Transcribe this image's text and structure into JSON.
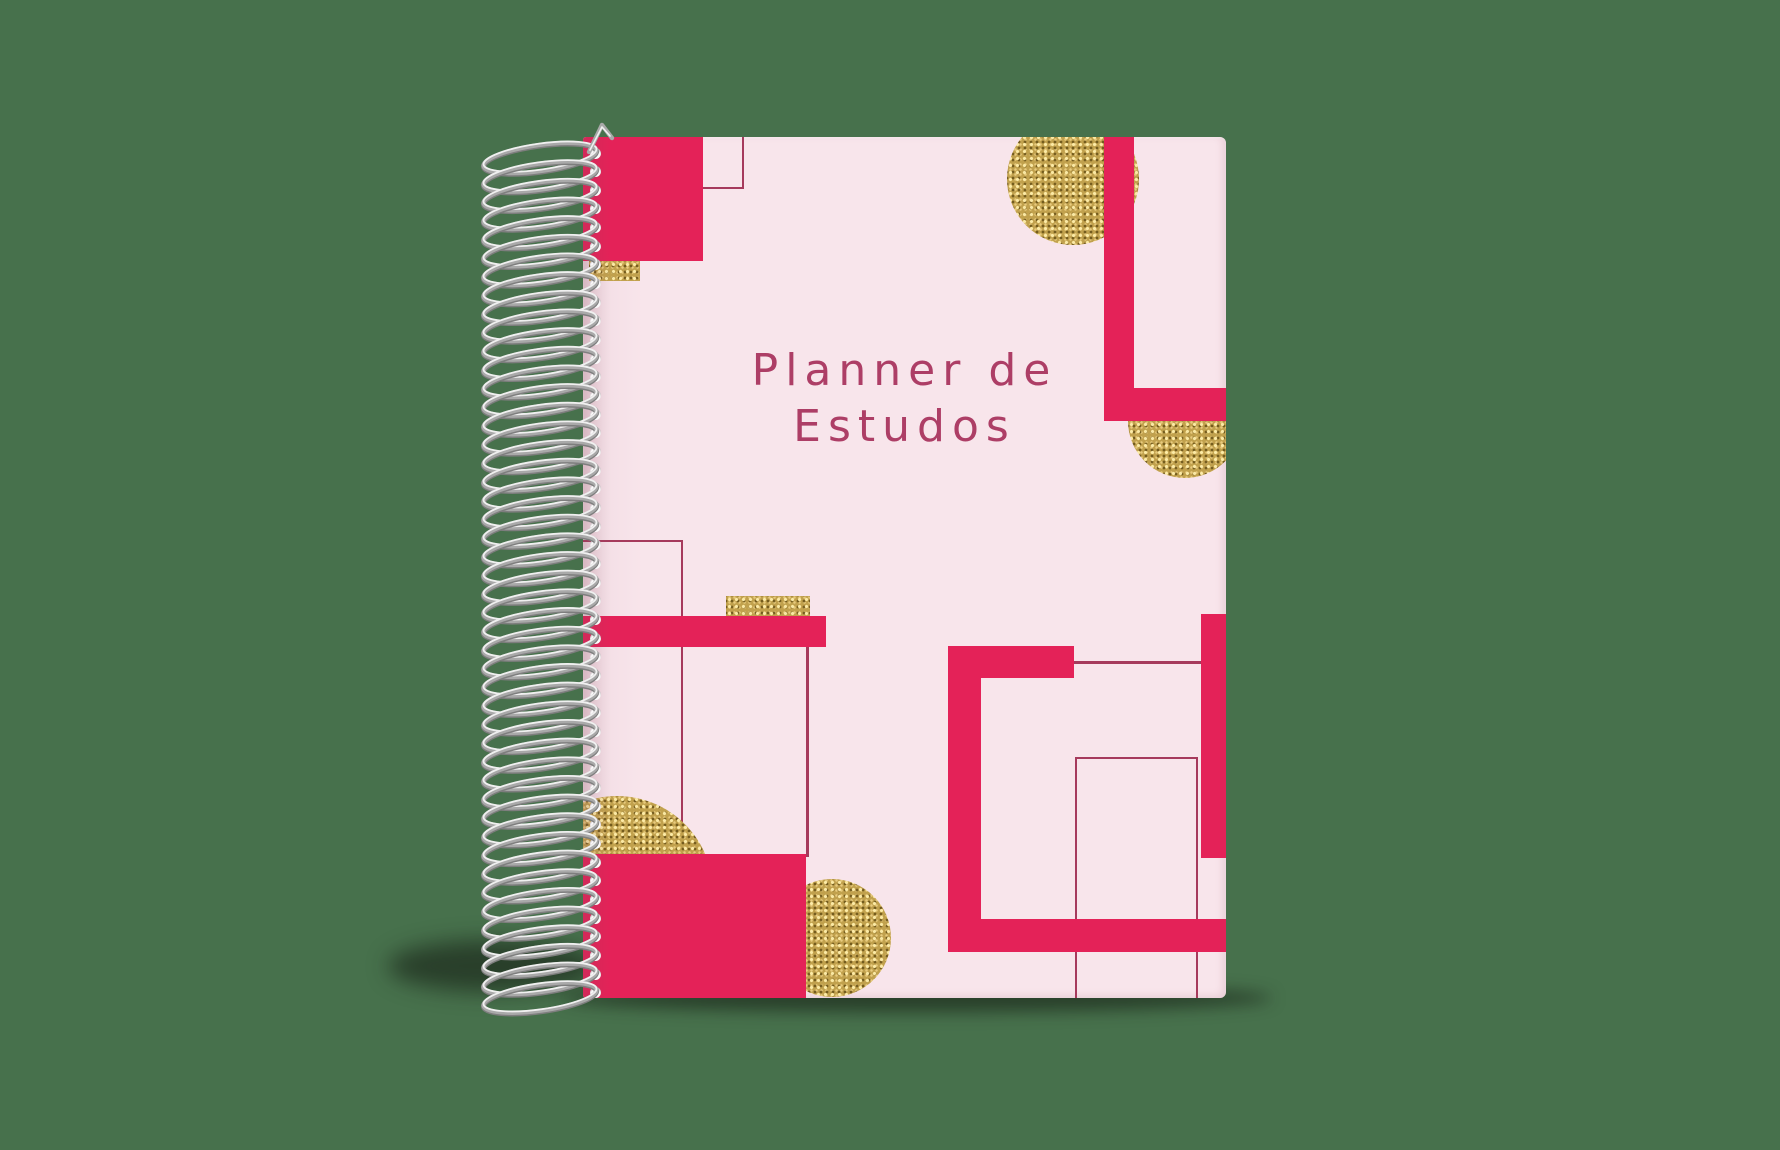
{
  "scene": {
    "background_color": "#47714C"
  },
  "notebook": {
    "cover": {
      "title_line1": "Planner de",
      "title_line2": "Estudos",
      "title_color": "#ad3e66",
      "base_color": "#f8e5eb",
      "accent_color": "#e42258",
      "outline_color": "#a63a5c",
      "gold_color": "#c1a14d"
    },
    "spiral": {
      "wire_base": "#a9a9a9",
      "wire_shade": "#7e7e7e",
      "wire_highlight": "#f0f0f0",
      "hole_color": "#fdfbfc",
      "loop_count": 46
    }
  }
}
